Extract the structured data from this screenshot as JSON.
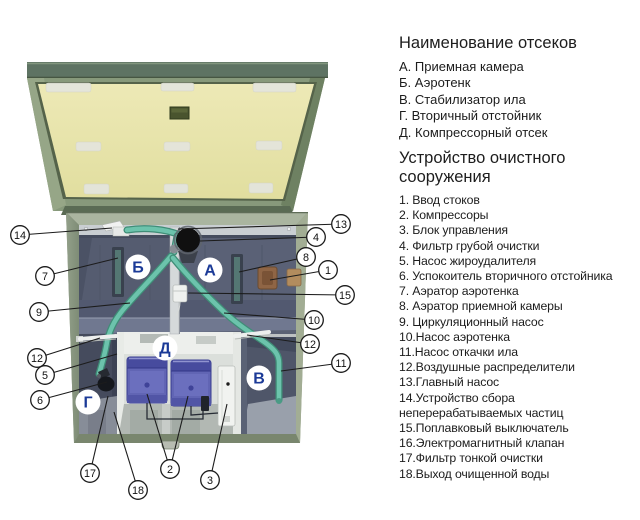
{
  "panel": {
    "compartments_title": "Наименование отсеков",
    "compartments": [
      "А. Приемная камера",
      "Б. Аэротенк",
      "В. Стабилизатор ила",
      "Г.  Вторичный отстойник",
      "Д. Компрессорный отсек"
    ],
    "devices_title": "Устройство очистного сооружения",
    "devices": [
      "1. Ввод стоков",
      "2. Компрессоры",
      "3. Блок управления",
      "4. Фильтр грубой очистки",
      "5. Насос жироудалителя",
      "6. Успокоитель вторичного отстойника",
      "7. Аэратор аэротенка",
      "8. Аэратор приемной камеры",
      "9. Циркуляционный насос",
      "10.Насос аэротенка",
      "11.Насос откачки ила",
      "12.Воздушные распределители",
      "13.Главный насос",
      "14.Устройство сбора неперерабатываемых частиц",
      "15.Поплавковый выключатель",
      "16.Электромагнитный клапан",
      "17.Фильтр тонкой очистки",
      "18.Выход очищенной воды"
    ]
  },
  "diagram": {
    "callouts": [
      "1",
      "2",
      "3",
      "4",
      "5",
      "6",
      "7",
      "8",
      "9",
      "10",
      "11",
      "12",
      "12",
      "13",
      "14",
      "15",
      "17",
      "18"
    ],
    "compartment_letters": [
      "А",
      "Б",
      "В",
      "Г",
      "Д"
    ],
    "colors": {
      "lid_panel": "#eae6ae",
      "lid_frame": "#87997b",
      "tank_wall": "#8e9b83",
      "interior": "#5a6174",
      "pipe": "#6cc3ac",
      "compressor": "#6165b4",
      "letter_blue": "#1b3a97"
    }
  }
}
